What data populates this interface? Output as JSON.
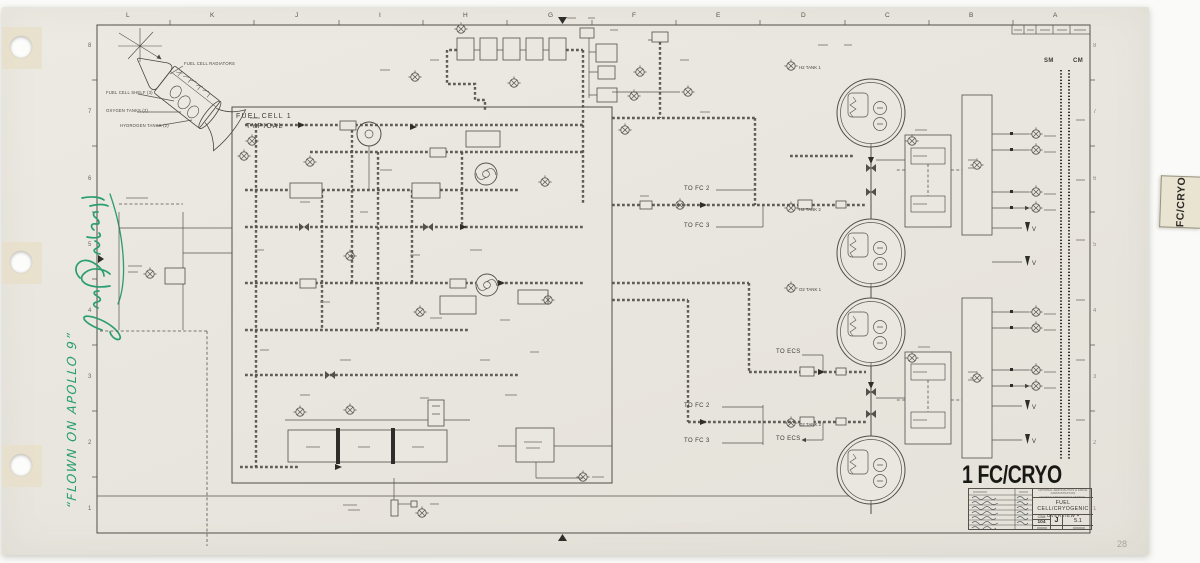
{
  "document": {
    "big_label": "1 FC/CRYO",
    "page_number": "28",
    "tab_label": "FC/CRYO"
  },
  "inscription": {
    "line": "“FLOWN ON APOLLO 9”",
    "signature": "Jim McDivitt",
    "ink_color": "#2a9d72"
  },
  "zones": {
    "top_letters": [
      "L",
      "K",
      "J",
      "I",
      "H",
      "G",
      "F",
      "E",
      "D",
      "C",
      "B",
      "A"
    ],
    "left_numbers": [
      "8",
      "7",
      "6",
      "5",
      "4",
      "3",
      "2",
      "1"
    ]
  },
  "spacecraft": {
    "labels": {
      "radiators": "FUEL CELL RADIATORS",
      "shelf": "FUEL CELL SHELF (3)",
      "oxygen": "OXYGEN TANKS (2)",
      "hydrogen": "HYDROGEN TANKS (2)"
    }
  },
  "schematic": {
    "fuel_cell_title_1": "FUEL CELL 1",
    "fuel_cell_title_2": "TYPICAL",
    "sm": "SM",
    "cm": "CM",
    "to_fc2": "TO FC 2",
    "to_fc3": "TO FC 3",
    "to_ecs": "TO ECS",
    "tank_labels": [
      "H2 TANK 1",
      "H2 TANK 2",
      "O2 TANK 1",
      "O2 TANK 2"
    ],
    "v_label": "V"
  },
  "title_block": {
    "agency_line1": "NATIONAL AERONAUTICS & SPACE ADMINISTRATION",
    "agency_line2": "MANNED SPACECRAFT CENTER · HOUSTON, TEXAS",
    "title_line1": "FUEL CELL/CRYOGENIC",
    "title_line2": "OVERVIEW ▪",
    "csm": "CSM",
    "csm_no": "104",
    "rev": "J",
    "sheet": "5.1"
  }
}
